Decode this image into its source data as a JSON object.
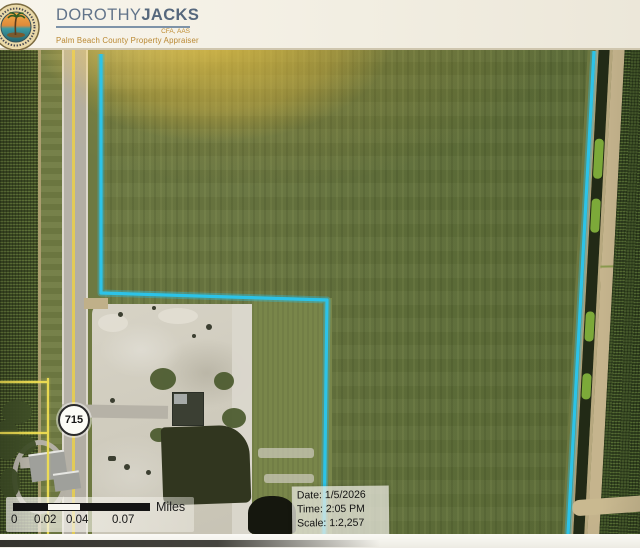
{
  "header": {
    "logo_first": "DOROTHY",
    "logo_last": "JACKS",
    "credentials": "CFA, AAS",
    "tagline": "Palm Beach County Property Appraiser"
  },
  "map": {
    "route_shield": "715",
    "boundary_color": "#2CC3E8",
    "parcel_line_color": "#F0DE52",
    "scale_bar": {
      "unit": "Miles",
      "ticks": [
        "0",
        "0.02",
        "0.04",
        "0.07"
      ]
    },
    "info": {
      "date_label": "Date:",
      "date": "1/5/2026",
      "time_label": "Time:",
      "time": "2:05 PM",
      "scale_label": "Scale:",
      "scale": "1:2,257"
    }
  }
}
